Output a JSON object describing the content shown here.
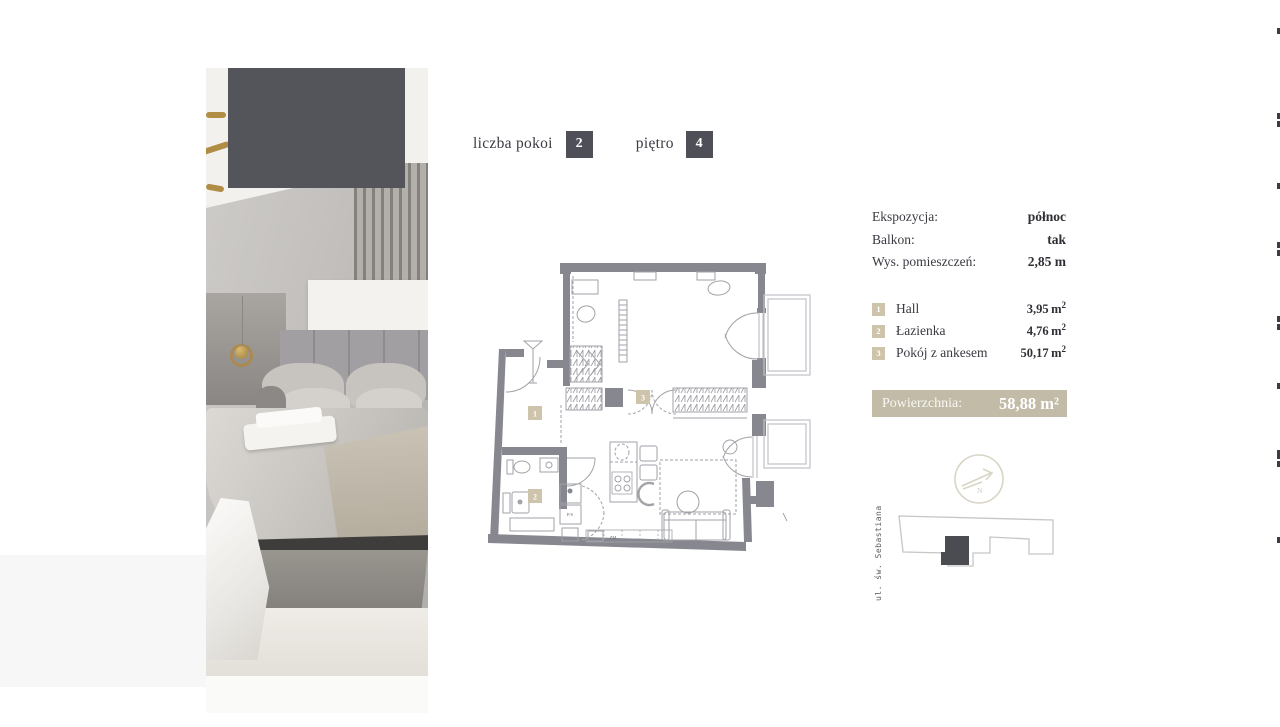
{
  "header": {
    "rooms_label": "liczba pokoi",
    "rooms_value": "2",
    "floor_label": "piętro",
    "floor_value": "4"
  },
  "details": {
    "rows": [
      {
        "label": "Ekspozycja:",
        "value": "północ"
      },
      {
        "label": "Balkon:",
        "value": "tak"
      },
      {
        "label": "Wys. pomieszczeń:",
        "value": "2,85 m"
      }
    ]
  },
  "legend": {
    "items": [
      {
        "num": "1",
        "name": "Hall",
        "area": "3,95"
      },
      {
        "num": "2",
        "name": "Łazienka",
        "area": "4,76"
      },
      {
        "num": "3",
        "name": "Pokój z ankesem",
        "area": "50,17"
      }
    ],
    "unit": "m",
    "sup": "2"
  },
  "total": {
    "label": "Powierzchnia:",
    "value": "58,88 m²"
  },
  "plan": {
    "labels": [
      "1",
      "2",
      "3"
    ],
    "ps": "P/S",
    "zm": "ZM"
  },
  "compass": {
    "north": "N"
  },
  "siteplan": {
    "street": "ul. św. Sebastiana"
  },
  "colors": {
    "accent_dark": "#4F4F58",
    "beige_square": "#CDC4AB",
    "total_bar": "#C2BBA8",
    "plan_wall": "#87878F"
  }
}
